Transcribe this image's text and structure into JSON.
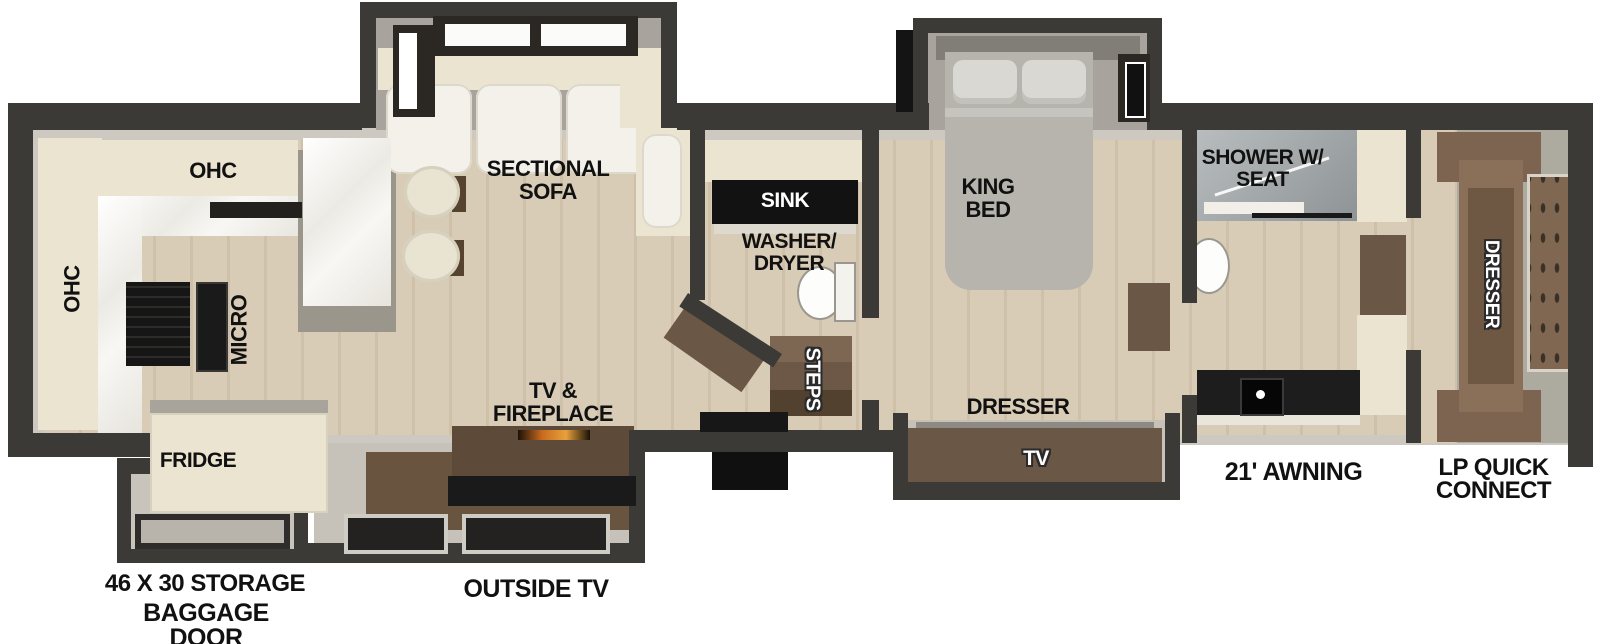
{
  "plan": {
    "labels": {
      "ohc_top": "OHC",
      "ohc_left": "OHC",
      "micro": "MICRO",
      "fridge": "FRIDGE",
      "sectional_sofa": "SECTIONAL SOFA",
      "tv_fireplace": "TV & FIREPLACE",
      "sink": "SINK",
      "washer_dryer": "WASHER/ DRYER",
      "steps": "STEPS",
      "king_bed": "KING BED",
      "bedroom_dresser": "DRESSER",
      "bedroom_tv": "TV",
      "shower": "SHOWER W/ SEAT",
      "front_dresser": "DRESSER"
    },
    "exterior_labels": {
      "storage": "46 X 30 STORAGE",
      "baggage_door": "BAGGAGE DOOR",
      "outside_tv": "OUTSIDE TV",
      "awning": "21' AWNING",
      "lp_quick_connect": "LP QUICK CONNECT"
    },
    "colors": {
      "wall": "#3b3a37",
      "wall_lining": "#cdc9c1",
      "floor_wood": "#d8cbb4",
      "cabinet_cream": "#ebe4d1",
      "counter_marble": "#f6f5f1",
      "slide_interior": "#a8a49d",
      "furniture_brown": "#6b5746",
      "appliance_black": "#161616",
      "bed_gray": "#b7b4ae",
      "shower_glass": "#9aa0a3",
      "label_text": "#111111",
      "label_text_outlined": "#ffffff"
    }
  }
}
